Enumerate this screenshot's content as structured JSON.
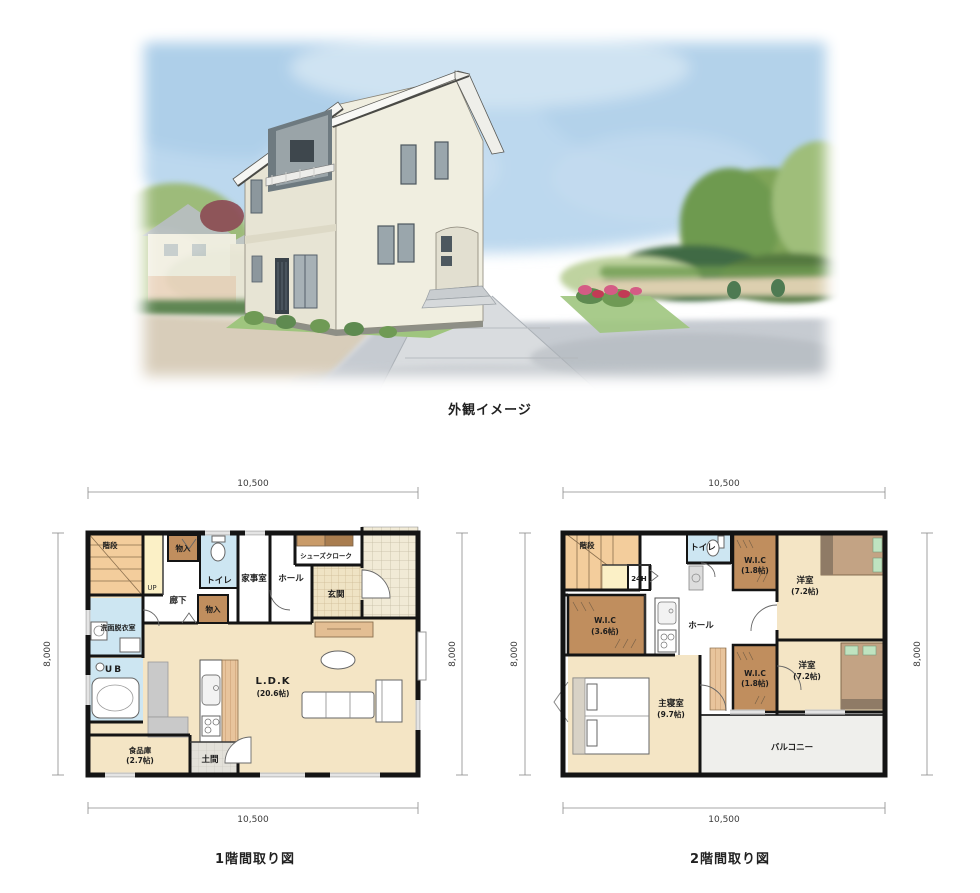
{
  "exterior": {
    "caption": "外観イメージ"
  },
  "dims": {
    "width": "10,500",
    "height": "8,000"
  },
  "floor1": {
    "caption": "1階間取り図",
    "rooms": {
      "stairs": "階段",
      "up": "UP",
      "storage1": "物入",
      "toilet": "トイレ",
      "utility": "家事室",
      "corridor": "廊下",
      "storage2": "物入",
      "hall": "ホール",
      "shoes_closet": "シューズクローク",
      "entrance": "玄関",
      "washroom": "洗面脱衣室",
      "bath": "UB",
      "ldk_name": "L.D.K",
      "ldk_size": "(20.6帖)",
      "pantry_name": "食品庫",
      "pantry_size": "(2.7帖)",
      "doma": "土間"
    }
  },
  "floor2": {
    "caption": "2階間取り図",
    "rooms": {
      "stairs": "階段",
      "vent": "24H",
      "toilet": "トイレ",
      "wic_top_name": "W.I.C",
      "wic_top_size": "(1.8帖)",
      "bedroom1_name": "洋室",
      "bedroom1_size": "(7.2帖)",
      "wic_mid_name": "W.I.C",
      "wic_mid_size": "(3.6帖)",
      "hall": "ホール",
      "wic_bottom_name": "W.I.C",
      "wic_bottom_size": "(1.8帖)",
      "bedroom2_name": "洋室",
      "bedroom2_size": "(7.2帖)",
      "master_name": "主寝室",
      "master_size": "(9.7帖)",
      "balcony": "バルコニー"
    }
  },
  "colors": {
    "floor_wheat": "#F4E5C5",
    "closet_brown": "#C08E5E",
    "wet_blue": "#CDE6F2",
    "stairs_orange": "#F3CD9C",
    "accent_cream": "#FBF0C6",
    "balcony_gray": "#EFEFEC",
    "wall_black": "#141414",
    "tile_cream": "#F1EAD6",
    "wood_counter": "#E8C49C",
    "sky_blue": "#BCD8EE",
    "grass_green": "#9FC57E",
    "road_gray": "#C6CBD1",
    "dirt_tan": "#D8CDBA"
  }
}
